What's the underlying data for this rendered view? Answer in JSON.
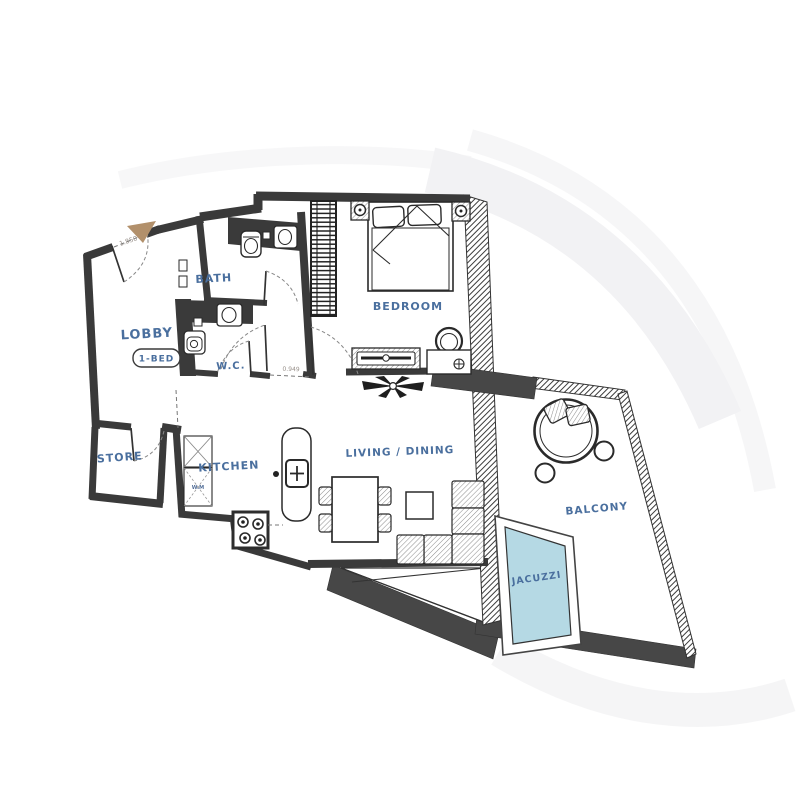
{
  "meta": {
    "drawing_type": "apartment floor plan",
    "unit_type": "1-BED"
  },
  "colors": {
    "label_blue": "#4a6f9e",
    "wall_dark": "#3a3a3a",
    "slab_gray": "#474747",
    "jacuzzi_fill": "#b5d9e4",
    "entry_arrow_tan": "#b2906b",
    "dimension_gray": "#98908a"
  },
  "rooms": {
    "lobby": {
      "label": "LOBBY",
      "badge": "1-BED"
    },
    "bath": {
      "label": "BATH"
    },
    "wc": {
      "label": "W.C."
    },
    "bedroom": {
      "label": "BEDROOM"
    },
    "store": {
      "label": "STORE"
    },
    "kitchen": {
      "label": "KITCHEN"
    },
    "living_dining": {
      "label": "LIVING / DINING"
    },
    "balcony": {
      "label": "BALCONY"
    },
    "jacuzzi": {
      "label": "JACUZZI"
    }
  },
  "dimensions": {
    "entrance_width": "1.850",
    "hall_opening_width": "0.949"
  },
  "appliances": {
    "washing_machine_label": "W.M"
  }
}
